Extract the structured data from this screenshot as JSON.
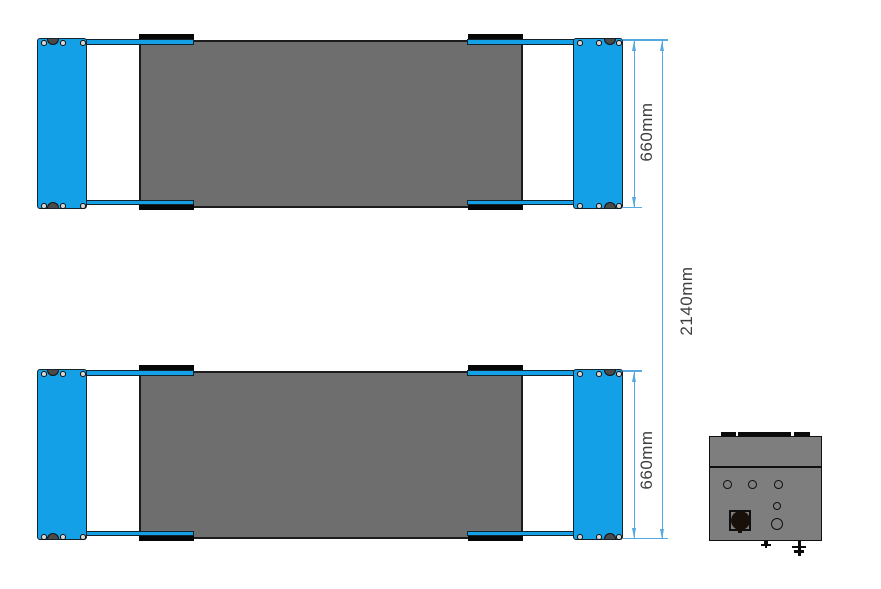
{
  "drawing": {
    "type": "technical-drawing",
    "view": "top-view",
    "subject": "two-platform scissor lift with power unit control box",
    "dimensions": {
      "upper_platform_width": {
        "label": "660mm"
      },
      "lower_platform_width": {
        "label": "660mm"
      },
      "overall_width": {
        "label": "2140mm"
      }
    },
    "colors": {
      "plate_blue": "#14A0E6",
      "dim_blue": "#55A9DE",
      "deck_gray": "#6E6E6E",
      "box_gray": "#7E7E7E",
      "label_gray": "#3F3F3F"
    }
  }
}
